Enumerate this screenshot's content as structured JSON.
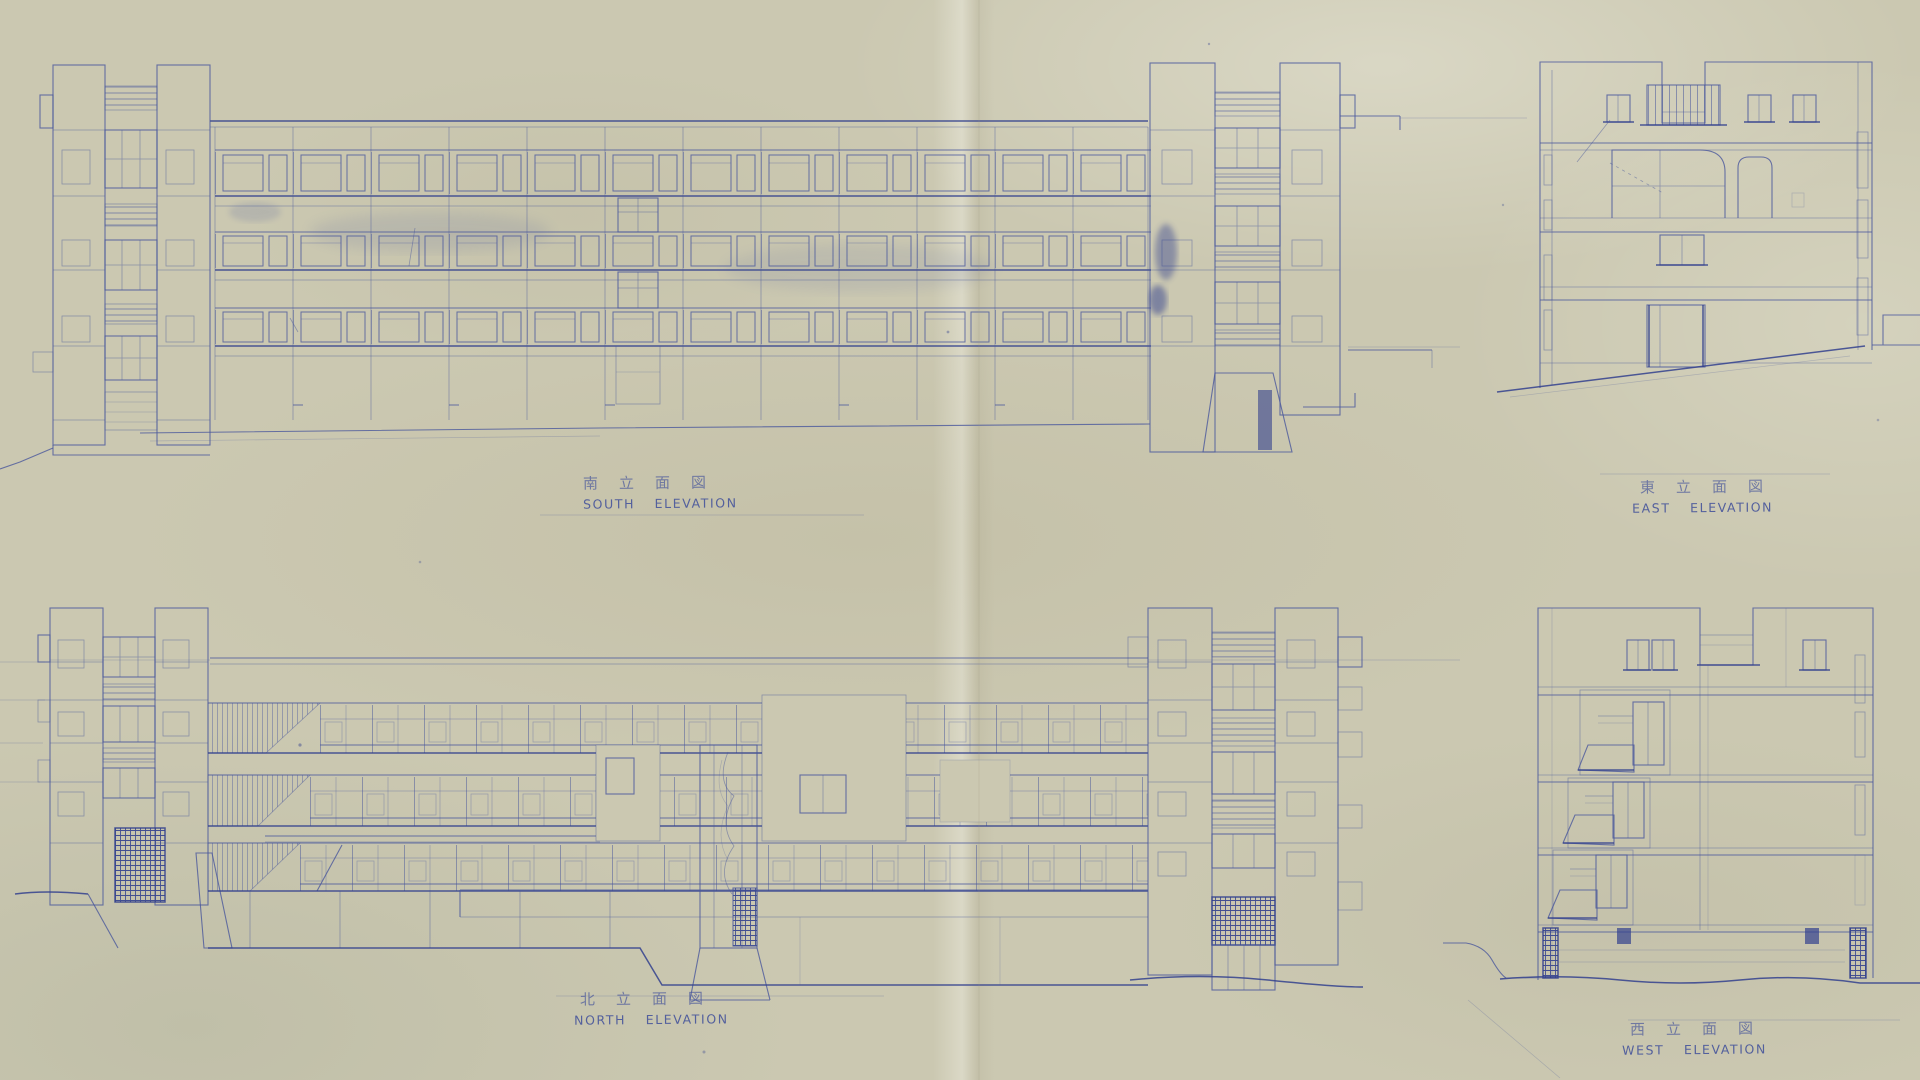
{
  "labels": {
    "south": {
      "kanji": "南立面図",
      "english": "SOUTH ELEVATION"
    },
    "east": {
      "kanji": "東立面図",
      "english": "EAST ELEVATION"
    },
    "north": {
      "kanji": "北立面図",
      "english": "NORTH ELEVATION"
    },
    "west": {
      "kanji": "西立面図",
      "english": "WEST ELEVATION"
    }
  },
  "colors": {
    "paper": "#cbc8b1",
    "ink": "#4a589c",
    "ink_strong": "#33418e",
    "ink_faint": "#8089b8"
  }
}
